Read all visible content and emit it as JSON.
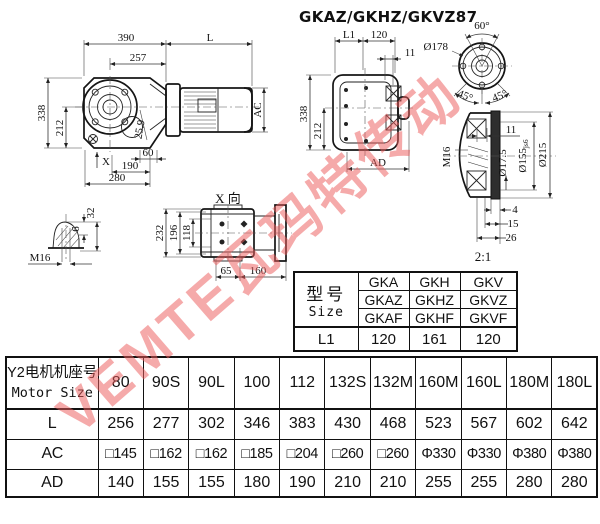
{
  "title": "GKAZ/GKHZ/GKVZ87",
  "watermark": "VEMTE瓦玛特传动",
  "colors": {
    "line": "#1c1c1c",
    "watermark": "#ef6a6a"
  },
  "views": {
    "front": {
      "w390": "390",
      "motor_l": "L",
      "w257": "257",
      "h338": "338",
      "h212": "212",
      "ac": "AC",
      "a259": "25.9",
      "d60": "60",
      "d190": "190",
      "d280": "280",
      "x_label": "X"
    },
    "side": {
      "l1": "L1",
      "d120": "120",
      "d11": "11",
      "h338": "338",
      "h212": "212",
      "ad": "AD"
    },
    "flange": {
      "a60": "60°",
      "d178": "Ø178",
      "a45l": "45°",
      "a45r": "45°"
    },
    "hub": {
      "m16": "M16",
      "d11": "11",
      "d175": "Ø17.5",
      "d155": "Ø155",
      "d155_tol": "js6",
      "d215": "Ø215",
      "d4": "4",
      "d15": "15",
      "d26": "26",
      "scale": "2:1"
    },
    "key": {
      "m16": "M16",
      "d6": "6",
      "d32": "32"
    },
    "xview": {
      "label": "X 向",
      "d232": "232",
      "d196": "196",
      "d118": "118",
      "d65": "65",
      "d160": "160"
    }
  },
  "size_table": {
    "header_cn": "型号",
    "header_en": "Size",
    "rows": [
      [
        "GKA",
        "GKH",
        "GKV"
      ],
      [
        "GKAZ",
        "GKHZ",
        "GKVZ"
      ],
      [
        "GKAF",
        "GKHF",
        "GKVF"
      ]
    ],
    "l1": {
      "label": "L1",
      "values": [
        "120",
        "161",
        "120"
      ]
    }
  },
  "motor_table": {
    "header_cn": "Y2电机机座号",
    "header_en": "Motor Size",
    "frames": [
      "80",
      "90S",
      "90L",
      "100",
      "112",
      "132S",
      "132M",
      "160M",
      "160L",
      "180M",
      "180L"
    ],
    "rows": [
      {
        "label": "L",
        "values": [
          "256",
          "277",
          "302",
          "346",
          "383",
          "430",
          "468",
          "523",
          "567",
          "602",
          "642"
        ]
      },
      {
        "label": "AC",
        "values": [
          "□145",
          "□162",
          "□162",
          "□185",
          "□204",
          "□260",
          "□260",
          "Φ330",
          "Φ330",
          "Φ380",
          "Φ380"
        ]
      },
      {
        "label": "AD",
        "values": [
          "140",
          "155",
          "155",
          "180",
          "190",
          "210",
          "210",
          "255",
          "255",
          "280",
          "280"
        ]
      }
    ]
  }
}
